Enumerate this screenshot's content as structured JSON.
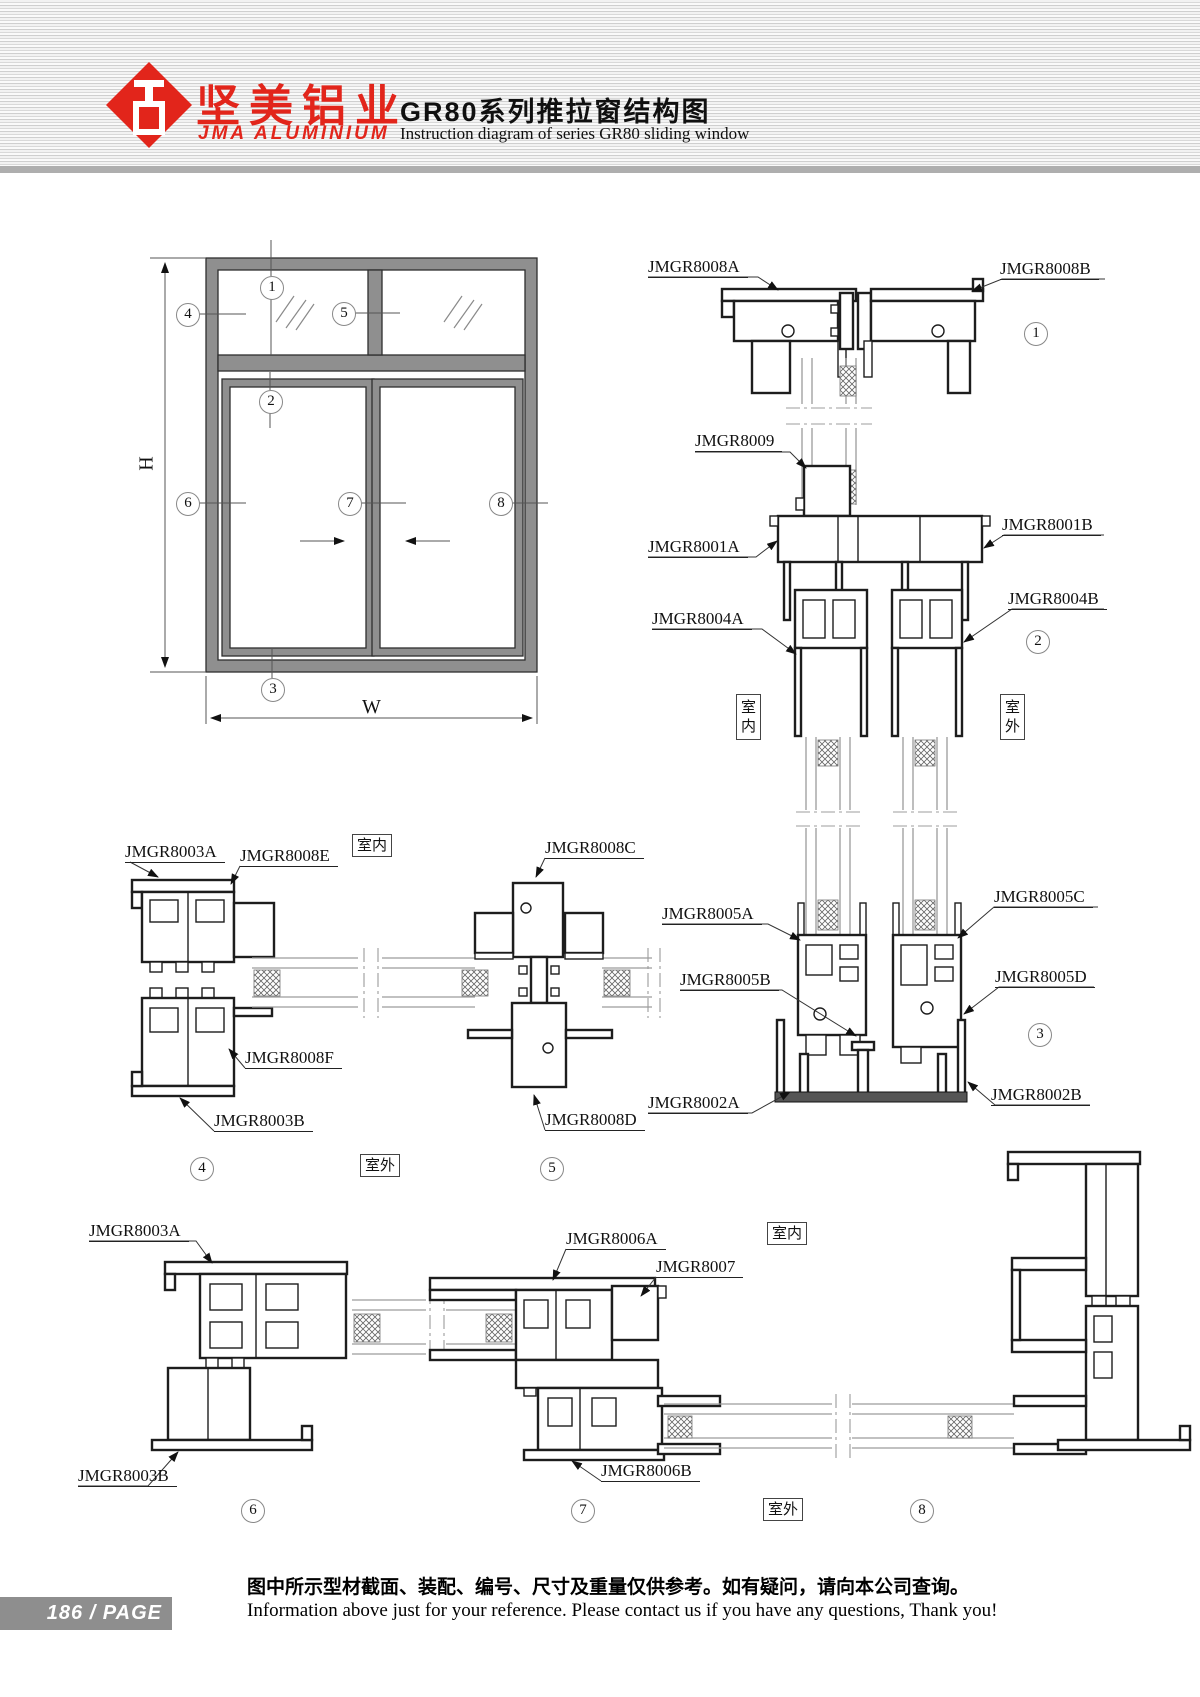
{
  "header": {
    "brand_cn": "坚美铝业",
    "brand_en": "JMA ALUMINIUM",
    "title_cn": "GR80系列推拉窗结构图",
    "title_en": "Instruction diagram of series GR80 sliding window"
  },
  "schematic": {
    "dim_h": "H",
    "dim_w": "W"
  },
  "callouts": {
    "c1": "1",
    "c2": "2",
    "c3": "3",
    "c4": "4",
    "c5": "5",
    "c6": "6",
    "c7": "7",
    "c8": "8"
  },
  "annotations": {
    "indoor": "室内",
    "outdoor": "室外"
  },
  "parts": {
    "p8008A": "JMGR8008A",
    "p8008B": "JMGR8008B",
    "p8008C": "JMGR8008C",
    "p8008D": "JMGR8008D",
    "p8008E": "JMGR8008E",
    "p8008F": "JMGR8008F",
    "p8009": "JMGR8009",
    "p8001A": "JMGR8001A",
    "p8001B": "JMGR8001B",
    "p8004A": "JMGR8004A",
    "p8004B": "JMGR8004B",
    "p8005A": "JMGR8005A",
    "p8005B": "JMGR8005B",
    "p8005C": "JMGR8005C",
    "p8005D": "JMGR8005D",
    "p8002A": "JMGR8002A",
    "p8002B": "JMGR8002B",
    "p8003A": "JMGR8003A",
    "p8003B": "JMGR8003B",
    "p8006A": "JMGR8006A",
    "p8006B": "JMGR8006B",
    "p8007": "JMGR8007"
  },
  "footer": {
    "page_badge": "186 / PAGE",
    "note_cn": "图中所示型材截面、装配、编号、尺寸及重量仅供参考。如有疑问，请向本公司查询。",
    "note_en": "Information above just for your reference. Please contact us if you have any questions, Thank you!"
  },
  "colors": {
    "brand_red": "#e2251b",
    "line_dark": "#1d1d1d",
    "frame_gray": "#8f8f8f"
  }
}
